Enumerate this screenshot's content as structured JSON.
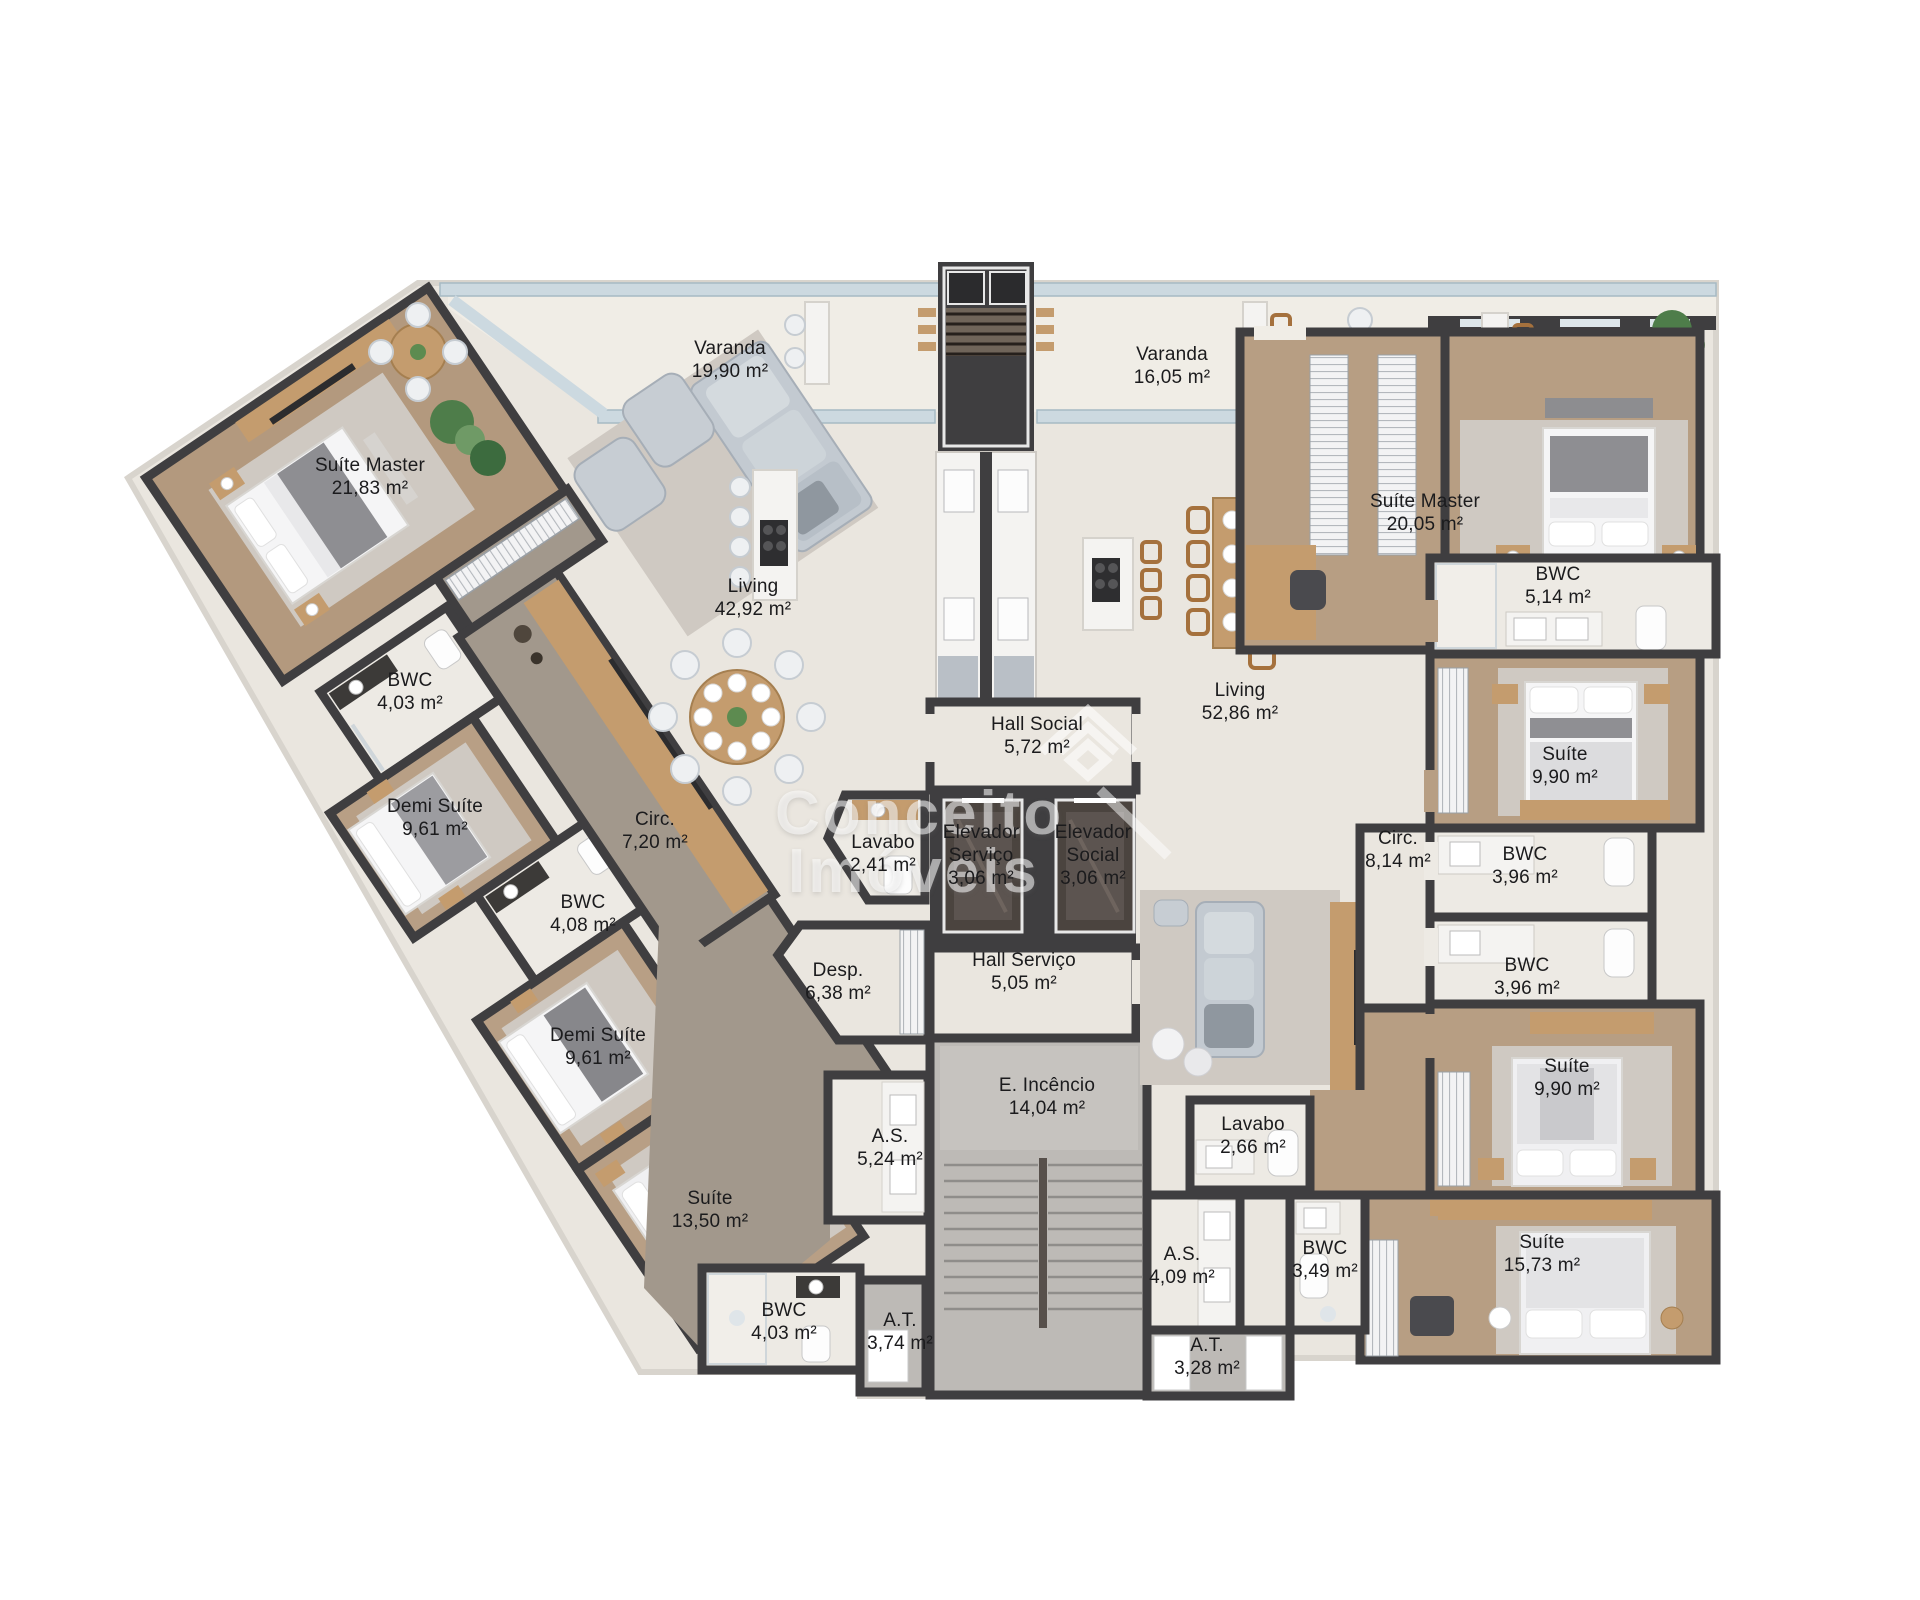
{
  "watermark": {
    "line1": "Conceito",
    "line2": "Imóveis",
    "logo": "conceito-imoveis-logo"
  },
  "rooms_left": [
    {
      "name": "Varanda",
      "area": "19,90 m²"
    },
    {
      "name": "Suíte Master",
      "area": "21,83 m²"
    },
    {
      "name": "Living",
      "area": "42,92 m²"
    },
    {
      "name": "BWC",
      "area": "4,03 m²"
    },
    {
      "name": "Demi Suíte",
      "area": "9,61 m²"
    },
    {
      "name": "Circ.",
      "area": "7,20 m²"
    },
    {
      "name": "BWC",
      "area": "4,08 m²"
    },
    {
      "name": "Demi Suíte",
      "area": "9,61 m²"
    },
    {
      "name": "Lavabo",
      "area": "2,41 m²"
    },
    {
      "name": "Desp.",
      "area": "6,38 m²"
    },
    {
      "name": "A.S.",
      "area": "5,24 m²"
    },
    {
      "name": "Suíte",
      "area": "13,50 m²"
    },
    {
      "name": "BWC",
      "area": "4,03 m²"
    },
    {
      "name": "A.T.",
      "area": "3,74 m²"
    }
  ],
  "rooms_core": [
    {
      "name": "Hall Social",
      "area": "5,72 m²"
    },
    {
      "name": "Elevador Serviço",
      "area": "3,06 m²"
    },
    {
      "name": "Elevador Social",
      "area": "3,06 m²"
    },
    {
      "name": "Hall Serviço",
      "area": "5,05 m²"
    },
    {
      "name": "E. Incêncio",
      "area": "14,04 m²"
    }
  ],
  "rooms_right": [
    {
      "name": "Varanda",
      "area": "16,05 m²"
    },
    {
      "name": "Suíte Master",
      "area": "20,05 m²"
    },
    {
      "name": "BWC",
      "area": "5,14 m²"
    },
    {
      "name": "Living",
      "area": "52,86 m²"
    },
    {
      "name": "Suíte",
      "area": "9,90 m²"
    },
    {
      "name": "Circ.",
      "area": "8,14 m²"
    },
    {
      "name": "BWC",
      "area": "3,96 m²"
    },
    {
      "name": "BWC",
      "area": "3,96 m²"
    },
    {
      "name": "Suíte",
      "area": "9,90 m²"
    },
    {
      "name": "Lavabo",
      "area": "2,66 m²"
    },
    {
      "name": "A.S.",
      "area": "4,09 m²"
    },
    {
      "name": "BWC",
      "area": "3,49 m²"
    },
    {
      "name": "Suíte",
      "area": "15,73 m²"
    },
    {
      "name": "A.T.",
      "area": "3,28 m²"
    }
  ],
  "colors": {
    "wall": "#3f3e40",
    "tile": "#eae6df",
    "varanda": "#f0ede6",
    "wood": "#b79e83",
    "wood_corridor": "#a2988c",
    "parapet": "#ccd9e0",
    "marble": "#f4f3f1",
    "rug": "#cfc9c2"
  }
}
